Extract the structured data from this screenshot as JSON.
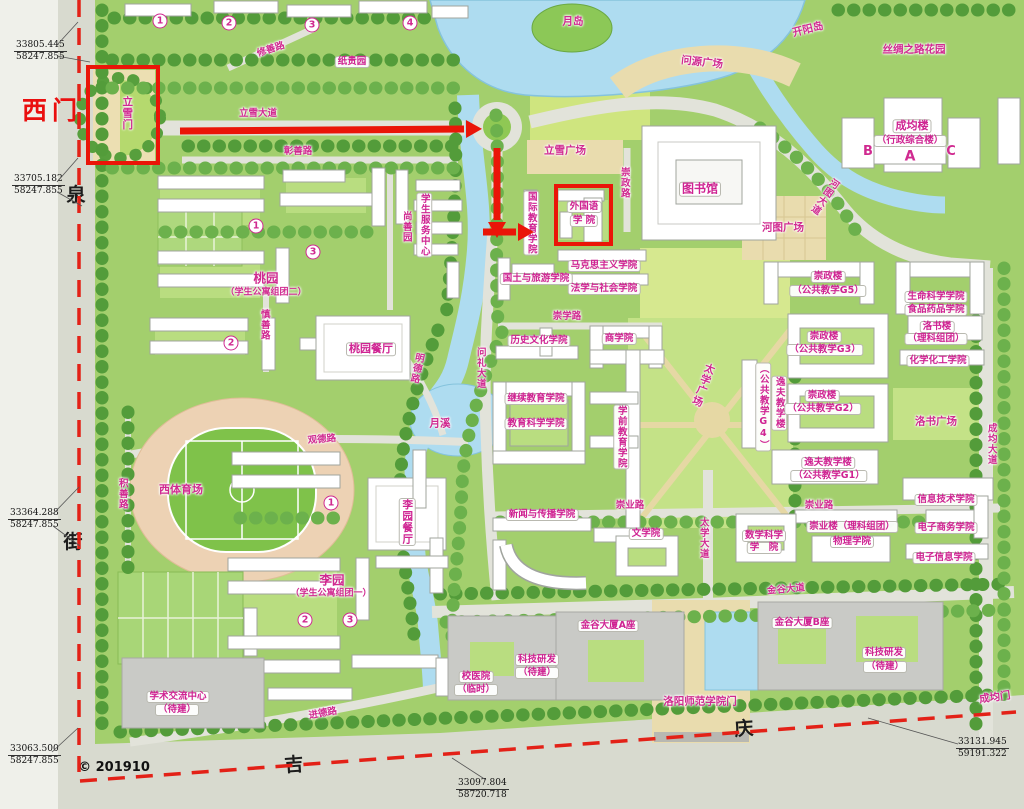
{
  "map_title": "campus master plan",
  "colors": {
    "label_magenta": "#d02a90",
    "annotation_red": "#ea1508",
    "water": "#aedcf0",
    "campus_green": "#a3cf6d",
    "road_gray": "#e2e3da"
  },
  "labels": [
    {
      "t": "修善路",
      "x": 271,
      "y": 50,
      "k": "road",
      "r": -18
    },
    {
      "t": "纸贵园",
      "x": 352,
      "y": 62,
      "k": "bldg"
    },
    {
      "t": "月岛",
      "x": 573,
      "y": 22,
      "k": "area"
    },
    {
      "t": "问源广场",
      "x": 702,
      "y": 63,
      "k": "area",
      "r": 6
    },
    {
      "t": "开阳岛",
      "x": 808,
      "y": 30,
      "k": "area",
      "r": -14
    },
    {
      "t": "丝绸之路花园",
      "x": 914,
      "y": 50,
      "k": "area"
    },
    {
      "t": "立雪大道",
      "x": 258,
      "y": 114,
      "k": "road"
    },
    {
      "t": "彰善路",
      "x": 298,
      "y": 152,
      "k": "road"
    },
    {
      "t": "立雪门",
      "x": 127,
      "y": 113,
      "k": "area",
      "v": 1,
      "n": "lixue-gate-label"
    },
    {
      "t": "西门",
      "x": 52,
      "y": 111,
      "k": "red",
      "n": "west-gate-label"
    },
    {
      "t": "立雪广场",
      "x": 565,
      "y": 151,
      "k": "area"
    },
    {
      "t": "崇政路",
      "x": 624,
      "y": 183,
      "k": "road",
      "v": 1
    },
    {
      "t": "成均楼",
      "x": 912,
      "y": 126,
      "k": "bldg",
      "s": 11
    },
    {
      "t": "（行政综合楼）",
      "x": 910,
      "y": 141,
      "k": "bldg"
    },
    {
      "t": "B",
      "x": 868,
      "y": 152,
      "k": "area",
      "s": 13
    },
    {
      "t": "A",
      "x": 910,
      "y": 157,
      "k": "area",
      "s": 14
    },
    {
      "t": "C",
      "x": 951,
      "y": 152,
      "k": "area",
      "s": 13
    },
    {
      "t": "图书馆",
      "x": 700,
      "y": 189,
      "k": "bldg",
      "s": 12,
      "n": "library-label"
    },
    {
      "t": "河图大道",
      "x": 824,
      "y": 196,
      "k": "road",
      "v": 1,
      "r": 35
    },
    {
      "t": "河图广场",
      "x": 783,
      "y": 228,
      "k": "area"
    },
    {
      "t": "外国语",
      "x": 584,
      "y": 207,
      "k": "bldg"
    },
    {
      "t": "学 院",
      "x": 584,
      "y": 221,
      "k": "bldg"
    },
    {
      "t": "国际教育学院",
      "x": 531,
      "y": 223,
      "k": "bldg",
      "v": 1
    },
    {
      "t": "学生服务中心",
      "x": 424,
      "y": 225,
      "k": "bldg",
      "v": 1
    },
    {
      "t": "尚善园",
      "x": 406,
      "y": 227,
      "k": "area",
      "v": 1,
      "s": 9.5
    },
    {
      "t": "马克思主义学院",
      "x": 604,
      "y": 266,
      "k": "bldg"
    },
    {
      "t": "国土与旅游学院",
      "x": 536,
      "y": 279,
      "k": "bldg"
    },
    {
      "t": "法学与社会学院",
      "x": 604,
      "y": 289,
      "k": "bldg"
    },
    {
      "t": "桃园",
      "x": 266,
      "y": 278,
      "k": "area",
      "s": 12.5
    },
    {
      "t": "（学生公寓组团二）",
      "x": 266,
      "y": 293,
      "k": "area",
      "s": 9
    },
    {
      "t": "慎善路",
      "x": 264,
      "y": 325,
      "k": "road",
      "v": 1
    },
    {
      "t": "桃园餐厅",
      "x": 371,
      "y": 349,
      "k": "bldg",
      "s": 11
    },
    {
      "t": "明德路",
      "x": 416,
      "y": 368,
      "k": "road",
      "v": 1,
      "r": 12
    },
    {
      "t": "月溪",
      "x": 440,
      "y": 424,
      "k": "area"
    },
    {
      "t": "观德路",
      "x": 322,
      "y": 440,
      "k": "road",
      "r": -5
    },
    {
      "t": "积善路",
      "x": 122,
      "y": 494,
      "k": "road",
      "v": 1
    },
    {
      "t": "西体育场",
      "x": 181,
      "y": 490,
      "k": "area",
      "s": 11
    },
    {
      "t": "崇学路",
      "x": 567,
      "y": 317,
      "k": "road"
    },
    {
      "t": "历史文化学院",
      "x": 539,
      "y": 341,
      "k": "bldg"
    },
    {
      "t": "商学院",
      "x": 619,
      "y": 339,
      "k": "bldg"
    },
    {
      "t": "太学广场",
      "x": 703,
      "y": 385,
      "k": "area",
      "v": 1,
      "r": 20
    },
    {
      "t": "继续教育学院",
      "x": 536,
      "y": 399,
      "k": "bldg"
    },
    {
      "t": "教育科学学院",
      "x": 536,
      "y": 424,
      "k": "bldg"
    },
    {
      "t": "学前教育学院",
      "x": 621,
      "y": 437,
      "k": "bldg",
      "v": 1
    },
    {
      "t": "问礼大道",
      "x": 480,
      "y": 368,
      "k": "road",
      "v": 1
    },
    {
      "t": "崇业路",
      "x": 630,
      "y": 506,
      "k": "road"
    },
    {
      "t": "新闻与传播学院",
      "x": 542,
      "y": 515,
      "k": "bldg"
    },
    {
      "t": "文学院",
      "x": 646,
      "y": 534,
      "k": "bldg"
    },
    {
      "t": "太学大道",
      "x": 703,
      "y": 538,
      "k": "road",
      "v": 1
    },
    {
      "t": "崇政楼",
      "x": 828,
      "y": 277,
      "k": "bldg"
    },
    {
      "t": "（公共教学G5）",
      "x": 828,
      "y": 291,
      "k": "bldg"
    },
    {
      "t": "生命科学学院",
      "x": 936,
      "y": 297,
      "k": "bldg"
    },
    {
      "t": "食品药品学院",
      "x": 936,
      "y": 310,
      "k": "bldg"
    },
    {
      "t": "崇政楼",
      "x": 824,
      "y": 337,
      "k": "bldg"
    },
    {
      "t": "（公共教学G3）",
      "x": 825,
      "y": 350,
      "k": "bldg"
    },
    {
      "t": "洛书楼",
      "x": 937,
      "y": 327,
      "k": "bldg"
    },
    {
      "t": "（理科组团）",
      "x": 936,
      "y": 339,
      "k": "bldg"
    },
    {
      "t": "化学化工学院",
      "x": 938,
      "y": 361,
      "k": "bldg"
    },
    {
      "t": "逸夫教学楼",
      "x": 779,
      "y": 403,
      "k": "bldg",
      "v": 1
    },
    {
      "t": "（公共教学G4）",
      "x": 763,
      "y": 407,
      "k": "bldg",
      "v": 1
    },
    {
      "t": "崇政楼",
      "x": 822,
      "y": 396,
      "k": "bldg"
    },
    {
      "t": "（公共教学G2）",
      "x": 823,
      "y": 409,
      "k": "bldg"
    },
    {
      "t": "洛书广场",
      "x": 936,
      "y": 422,
      "k": "area"
    },
    {
      "t": "成均大道",
      "x": 991,
      "y": 444,
      "k": "road",
      "v": 1
    },
    {
      "t": "逸夫教学楼",
      "x": 828,
      "y": 463,
      "k": "bldg"
    },
    {
      "t": "（公共教学G1）",
      "x": 829,
      "y": 476,
      "k": "bldg"
    },
    {
      "t": "崇业路",
      "x": 819,
      "y": 506,
      "k": "road"
    },
    {
      "t": "信息技术学院",
      "x": 946,
      "y": 500,
      "k": "bldg"
    },
    {
      "t": "崇业楼（理科组团）",
      "x": 852,
      "y": 527,
      "k": "bldg"
    },
    {
      "t": "电子商务学院",
      "x": 946,
      "y": 528,
      "k": "bldg"
    },
    {
      "t": "物理学院",
      "x": 852,
      "y": 542,
      "k": "bldg"
    },
    {
      "t": "数学科学",
      "x": 764,
      "y": 536,
      "k": "bldg"
    },
    {
      "t": "学　院",
      "x": 764,
      "y": 548,
      "k": "bldg"
    },
    {
      "t": "电子信息学院",
      "x": 944,
      "y": 558,
      "k": "bldg"
    },
    {
      "t": "李园",
      "x": 332,
      "y": 580,
      "k": "area",
      "s": 12.5
    },
    {
      "t": "（学生公寓组团一）",
      "x": 331,
      "y": 594,
      "k": "area",
      "s": 9
    },
    {
      "t": "李园餐厅",
      "x": 407,
      "y": 522,
      "k": "bldg",
      "v": 1,
      "s": 10.5
    },
    {
      "t": "金谷大道",
      "x": 786,
      "y": 590,
      "k": "road",
      "r": -5
    },
    {
      "t": "金谷大厦A座",
      "x": 608,
      "y": 626,
      "k": "bldg"
    },
    {
      "t": "科技研发",
      "x": 537,
      "y": 660,
      "k": "bldg"
    },
    {
      "t": "（待建）",
      "x": 537,
      "y": 673,
      "k": "bldg"
    },
    {
      "t": "校医院",
      "x": 476,
      "y": 677,
      "k": "bldg"
    },
    {
      "t": "（临时）",
      "x": 476,
      "y": 690,
      "k": "bldg"
    },
    {
      "t": "洛阳师范学院门",
      "x": 700,
      "y": 702,
      "k": "area",
      "n": "main-gate-label"
    },
    {
      "t": "金谷大厦B座",
      "x": 802,
      "y": 623,
      "k": "bldg"
    },
    {
      "t": "科技研发",
      "x": 884,
      "y": 653,
      "k": "bldg"
    },
    {
      "t": "（待建）",
      "x": 885,
      "y": 667,
      "k": "bldg"
    },
    {
      "t": "成均门",
      "x": 995,
      "y": 698,
      "k": "area",
      "r": -8,
      "n": "chengjun-gate-label"
    },
    {
      "t": "学术交流中心",
      "x": 178,
      "y": 697,
      "k": "bldg"
    },
    {
      "t": "（待建）",
      "x": 177,
      "y": 710,
      "k": "bldg"
    },
    {
      "t": "进德路",
      "x": 323,
      "y": 714,
      "k": "road",
      "r": -10
    },
    {
      "t": "泉",
      "x": 76,
      "y": 196,
      "k": "black"
    },
    {
      "t": "街",
      "x": 73,
      "y": 543,
      "k": "black"
    },
    {
      "t": "吉",
      "x": 294,
      "y": 766,
      "k": "black",
      "r": -4
    },
    {
      "t": "庆",
      "x": 744,
      "y": 730,
      "k": "black",
      "r": -4
    },
    {
      "t": "© 201910",
      "x": 114,
      "y": 768,
      "k": "copy",
      "n": "copyright"
    }
  ],
  "badges": [
    {
      "t": "1",
      "x": 160,
      "y": 21
    },
    {
      "t": "2",
      "x": 229,
      "y": 23
    },
    {
      "t": "3",
      "x": 312,
      "y": 25
    },
    {
      "t": "4",
      "x": 410,
      "y": 23
    },
    {
      "t": "1",
      "x": 256,
      "y": 226
    },
    {
      "t": "3",
      "x": 313,
      "y": 252
    },
    {
      "t": "2",
      "x": 231,
      "y": 343
    },
    {
      "t": "1",
      "x": 331,
      "y": 503
    },
    {
      "t": "2",
      "x": 305,
      "y": 620
    },
    {
      "t": "3",
      "x": 350,
      "y": 620
    }
  ],
  "coords": [
    {
      "a": "33805.445",
      "b": "58247.855",
      "x": 14,
      "y": 40
    },
    {
      "a": "33705.182",
      "b": "58247.855",
      "x": 12,
      "y": 174
    },
    {
      "a": "33364.288",
      "b": "58247.855",
      "x": 8,
      "y": 508
    },
    {
      "a": "33063.500",
      "b": "58247.855",
      "x": 8,
      "y": 744
    },
    {
      "a": "33097.804",
      "b": "58720.718",
      "x": 456,
      "y": 778
    },
    {
      "a": "33131.945",
      "b": "59191.322",
      "x": 956,
      "y": 737
    }
  ],
  "overlay": [
    {
      "type": "dash",
      "x1": 79,
      "y1": 0,
      "x2": 79,
      "y2": 772
    },
    {
      "type": "dash",
      "x1": 80,
      "y1": 781,
      "x2": 1016,
      "y2": 712
    },
    {
      "type": "box",
      "x": 88,
      "y": 67,
      "w": 70,
      "h": 96,
      "n": "highlight-west-gate-garden"
    },
    {
      "type": "box",
      "x": 556,
      "y": 186,
      "w": 55,
      "h": 58,
      "n": "highlight-foreign-languages"
    },
    {
      "type": "arrow",
      "x1": 180,
      "y1": 131,
      "x2": 466,
      "y2": 129
    },
    {
      "type": "arrow",
      "x1": 497,
      "y1": 148,
      "x2": 497,
      "y2": 222
    },
    {
      "type": "arrow",
      "x1": 483,
      "y1": 232,
      "x2": 518,
      "y2": 232
    },
    {
      "type": "leader",
      "x1": 57,
      "y1": 45,
      "x2": 78,
      "y2": 22
    },
    {
      "type": "leader",
      "x1": 57,
      "y1": 56,
      "x2": 90,
      "y2": 62
    },
    {
      "type": "leader",
      "x1": 57,
      "y1": 182,
      "x2": 78,
      "y2": 158
    },
    {
      "type": "leader",
      "x1": 57,
      "y1": 192,
      "x2": 82,
      "y2": 206
    },
    {
      "type": "leader",
      "x1": 53,
      "y1": 514,
      "x2": 79,
      "y2": 487
    },
    {
      "type": "leader",
      "x1": 53,
      "y1": 526,
      "x2": 80,
      "y2": 546
    },
    {
      "type": "leader",
      "x1": 52,
      "y1": 752,
      "x2": 78,
      "y2": 728
    },
    {
      "type": "leader",
      "x1": 486,
      "y1": 780,
      "x2": 452,
      "y2": 758
    },
    {
      "type": "leader",
      "x1": 958,
      "y1": 744,
      "x2": 868,
      "y2": 718
    }
  ]
}
